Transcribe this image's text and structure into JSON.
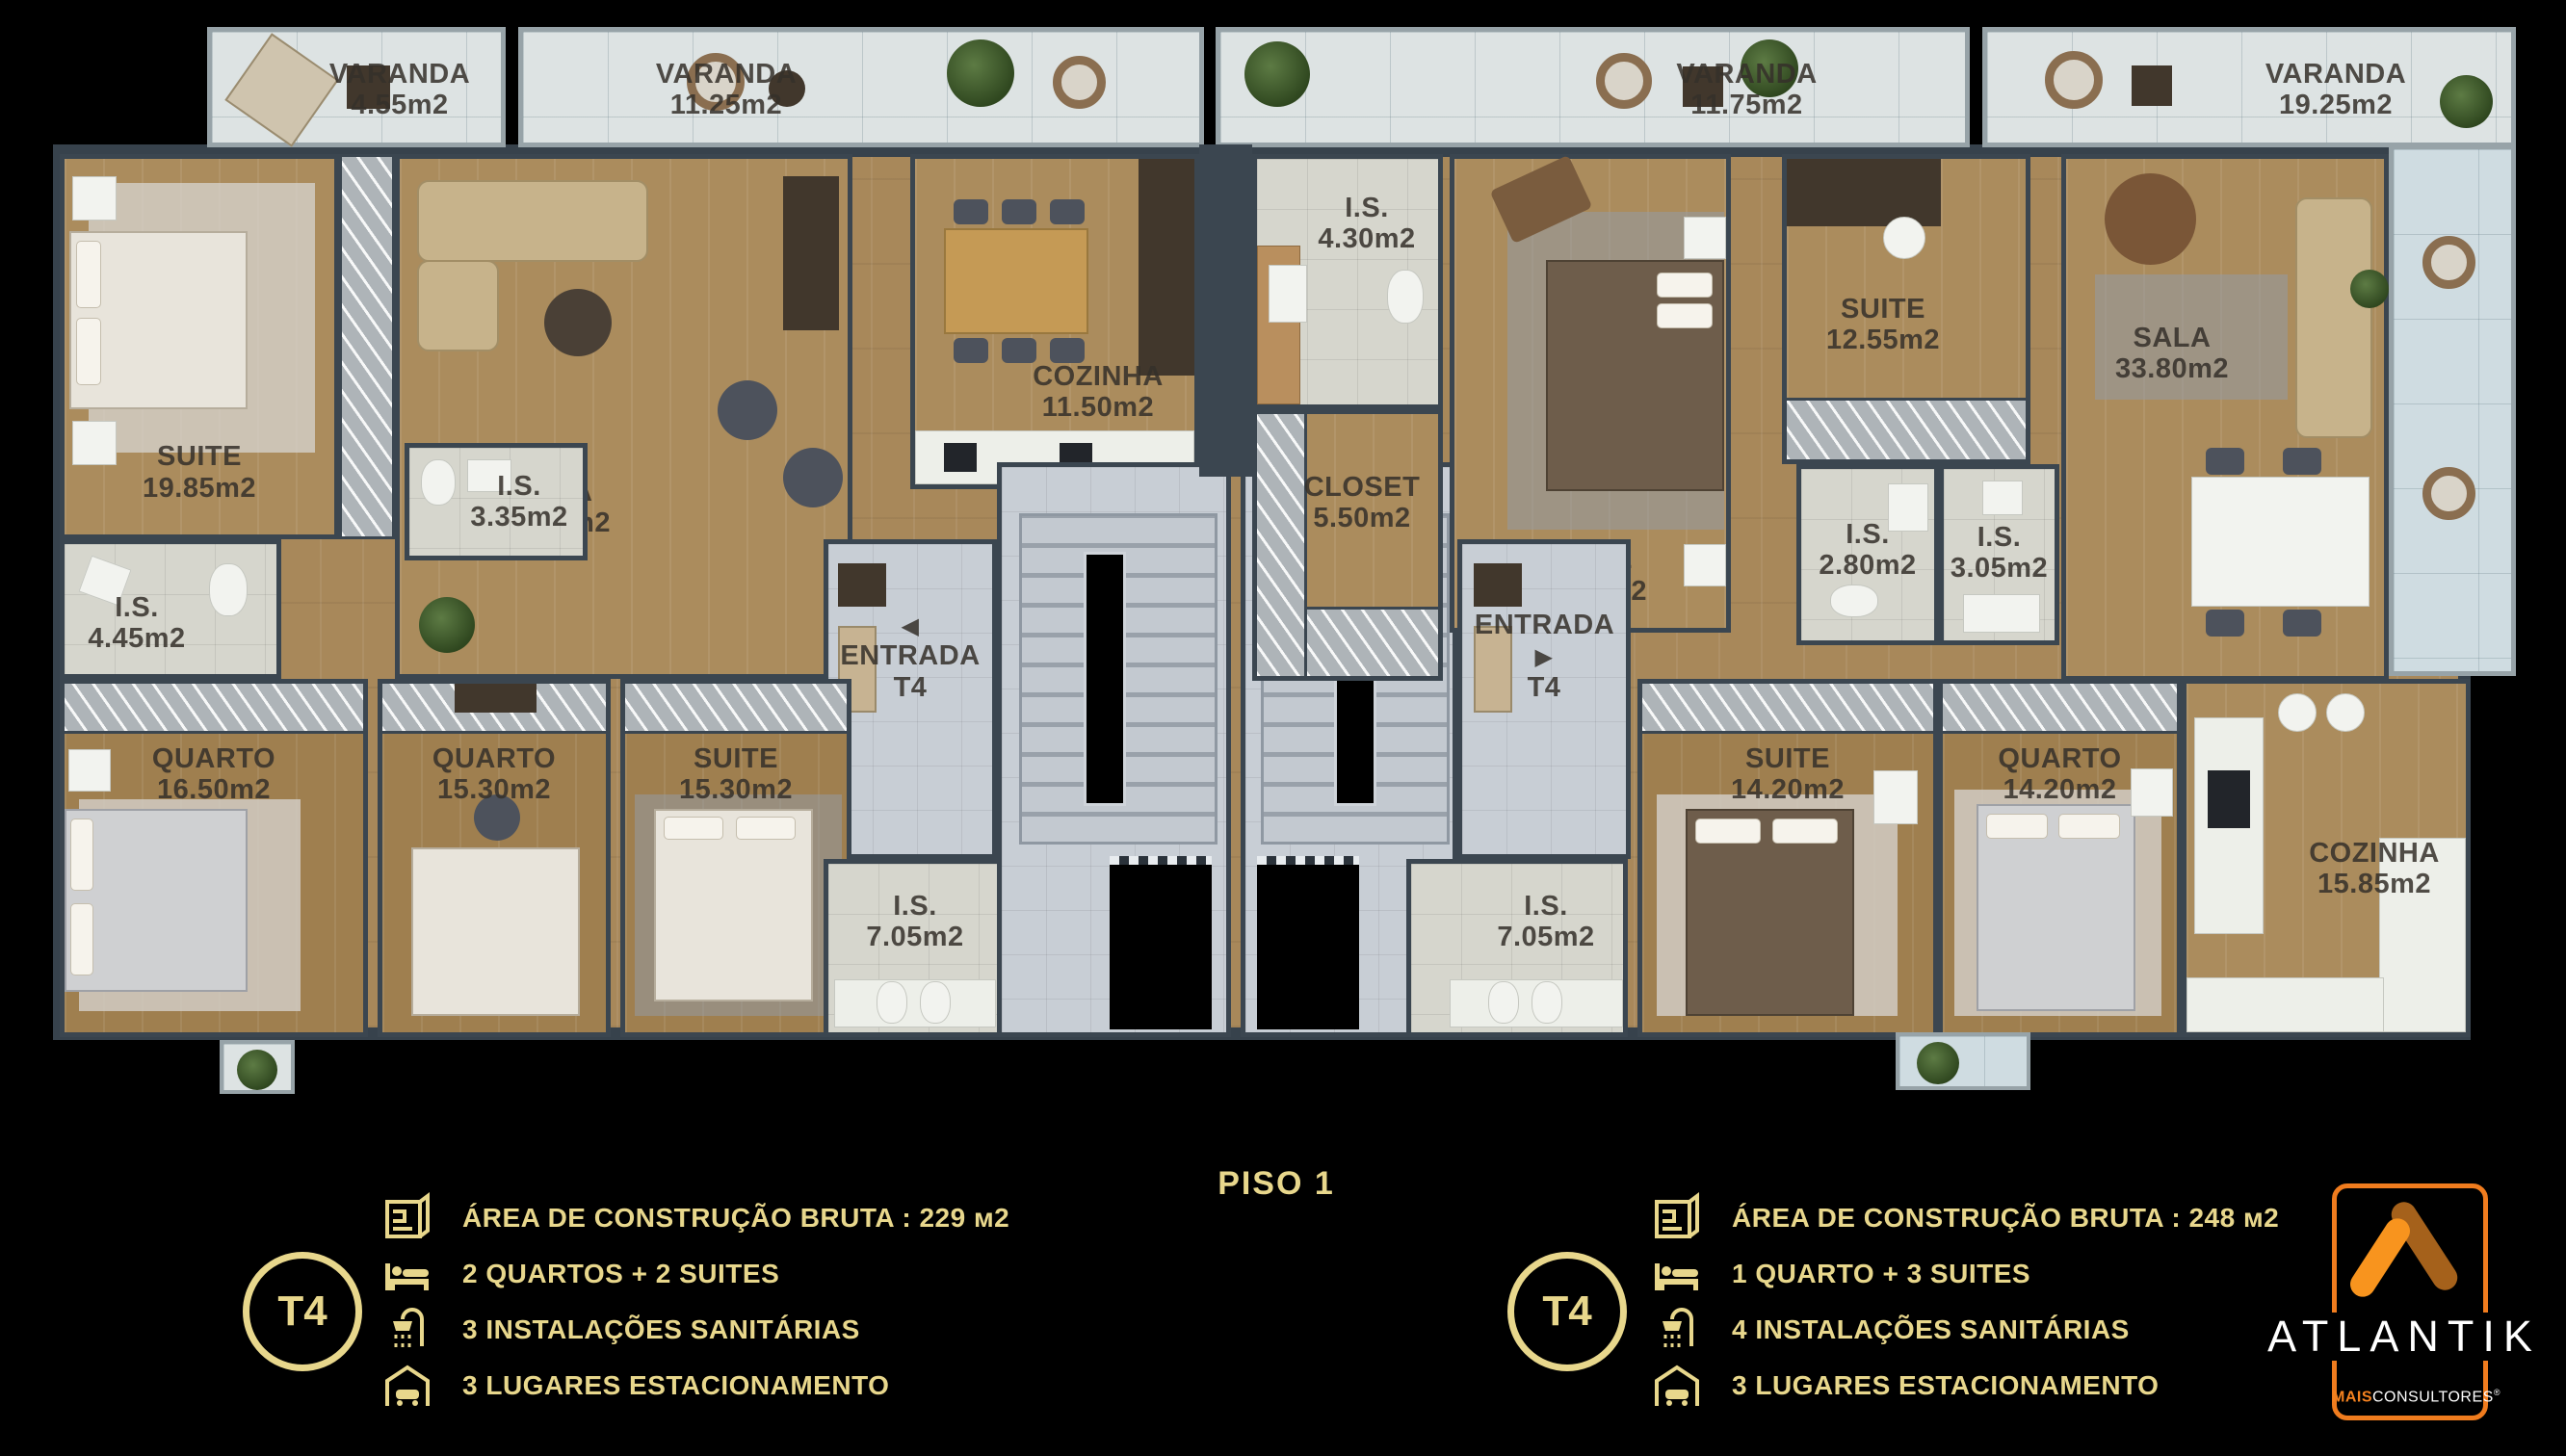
{
  "title": "PISO 1",
  "arrows": {
    "left": "◀",
    "right": "▶"
  },
  "rooms": [
    {
      "id": "varanda-a-small",
      "name": "VARANDA",
      "area": "4.55m2"
    },
    {
      "id": "varanda-a-large",
      "name": "VARANDA",
      "area": "11.25m2"
    },
    {
      "id": "suite-a",
      "name": "SUITE",
      "area": "19.85m2"
    },
    {
      "id": "is-a1",
      "name": "I.S.",
      "area": "4.45m2"
    },
    {
      "id": "is-a2",
      "name": "I.S.",
      "area": "3.35m2"
    },
    {
      "id": "sala-a",
      "name": "SALA",
      "area": "36.95m2"
    },
    {
      "id": "cozinha-a",
      "name": "COZINHA",
      "area": "11.50m2"
    },
    {
      "id": "entrada-a",
      "name": "ENTRADA",
      "area": "T4"
    },
    {
      "id": "quarto-a1",
      "name": "QUARTO",
      "area": "16.50m2"
    },
    {
      "id": "quarto-a2",
      "name": "QUARTO",
      "area": "15.30m2"
    },
    {
      "id": "suite-a2",
      "name": "SUITE",
      "area": "15.30m2"
    },
    {
      "id": "is-a3",
      "name": "I.S.",
      "area": "7.05m2"
    },
    {
      "id": "is-b1",
      "name": "I.S.",
      "area": "4.30m2"
    },
    {
      "id": "closet-b",
      "name": "CLOSET",
      "area": "5.50m2"
    },
    {
      "id": "suite-b1",
      "name": "SUITE",
      "area": "16.90m2"
    },
    {
      "id": "suite-b2",
      "name": "SUITE",
      "area": "12.55m2"
    },
    {
      "id": "is-b2",
      "name": "I.S.",
      "area": "2.80m2"
    },
    {
      "id": "is-b3",
      "name": "I.S.",
      "area": "3.05m2"
    },
    {
      "id": "sala-b",
      "name": "SALA",
      "area": "33.80m2"
    },
    {
      "id": "varanda-b1",
      "name": "VARANDA",
      "area": "11.75m2"
    },
    {
      "id": "varanda-b2",
      "name": "VARANDA",
      "area": "19.25m2"
    },
    {
      "id": "entrada-b",
      "name": "ENTRADA",
      "area": "T4"
    },
    {
      "id": "is-b4",
      "name": "I.S.",
      "area": "7.05m2"
    },
    {
      "id": "suite-b3",
      "name": "SUITE",
      "area": "14.20m2"
    },
    {
      "id": "quarto-b",
      "name": "QUARTO",
      "area": "14.20m2"
    },
    {
      "id": "cozinha-b",
      "name": "COZINHA",
      "area": "15.85m2"
    }
  ],
  "legend_left": {
    "badge": "T4",
    "items": [
      {
        "icon": "blueprint-icon",
        "text": "ÁREA DE CONSTRUÇÃO BRUTA :  229 м2"
      },
      {
        "icon": "bed-icon",
        "text": "2 QUARTOS + 2 SUITES"
      },
      {
        "icon": "shower-icon",
        "text": "3 INSTALAÇÕES SANITÁRIAS"
      },
      {
        "icon": "garage-icon",
        "text": "3 LUGARES ESTACIONAMENTO"
      }
    ]
  },
  "legend_right": {
    "badge": "T4",
    "items": [
      {
        "icon": "blueprint-icon",
        "text": "ÁREA DE CONSTRUÇÃO BRUTA :  248 м2"
      },
      {
        "icon": "bed-icon",
        "text": "1 QUARTO + 3 SUITES"
      },
      {
        "icon": "shower-icon",
        "text": "4 INSTALAÇÕES SANITÁRIAS"
      },
      {
        "icon": "garage-icon",
        "text": "3 LUGARES ESTACIONAMENTO"
      }
    ]
  },
  "brand": {
    "name": "ATLANTIK",
    "mais": "MAIS",
    "consultores": "CONSULTORES",
    "reg": "®"
  },
  "colors": {
    "gold": "#E8D78C",
    "orange": "#F5821F",
    "orange_dark": "#A5611B",
    "wall": "#3B4650"
  }
}
